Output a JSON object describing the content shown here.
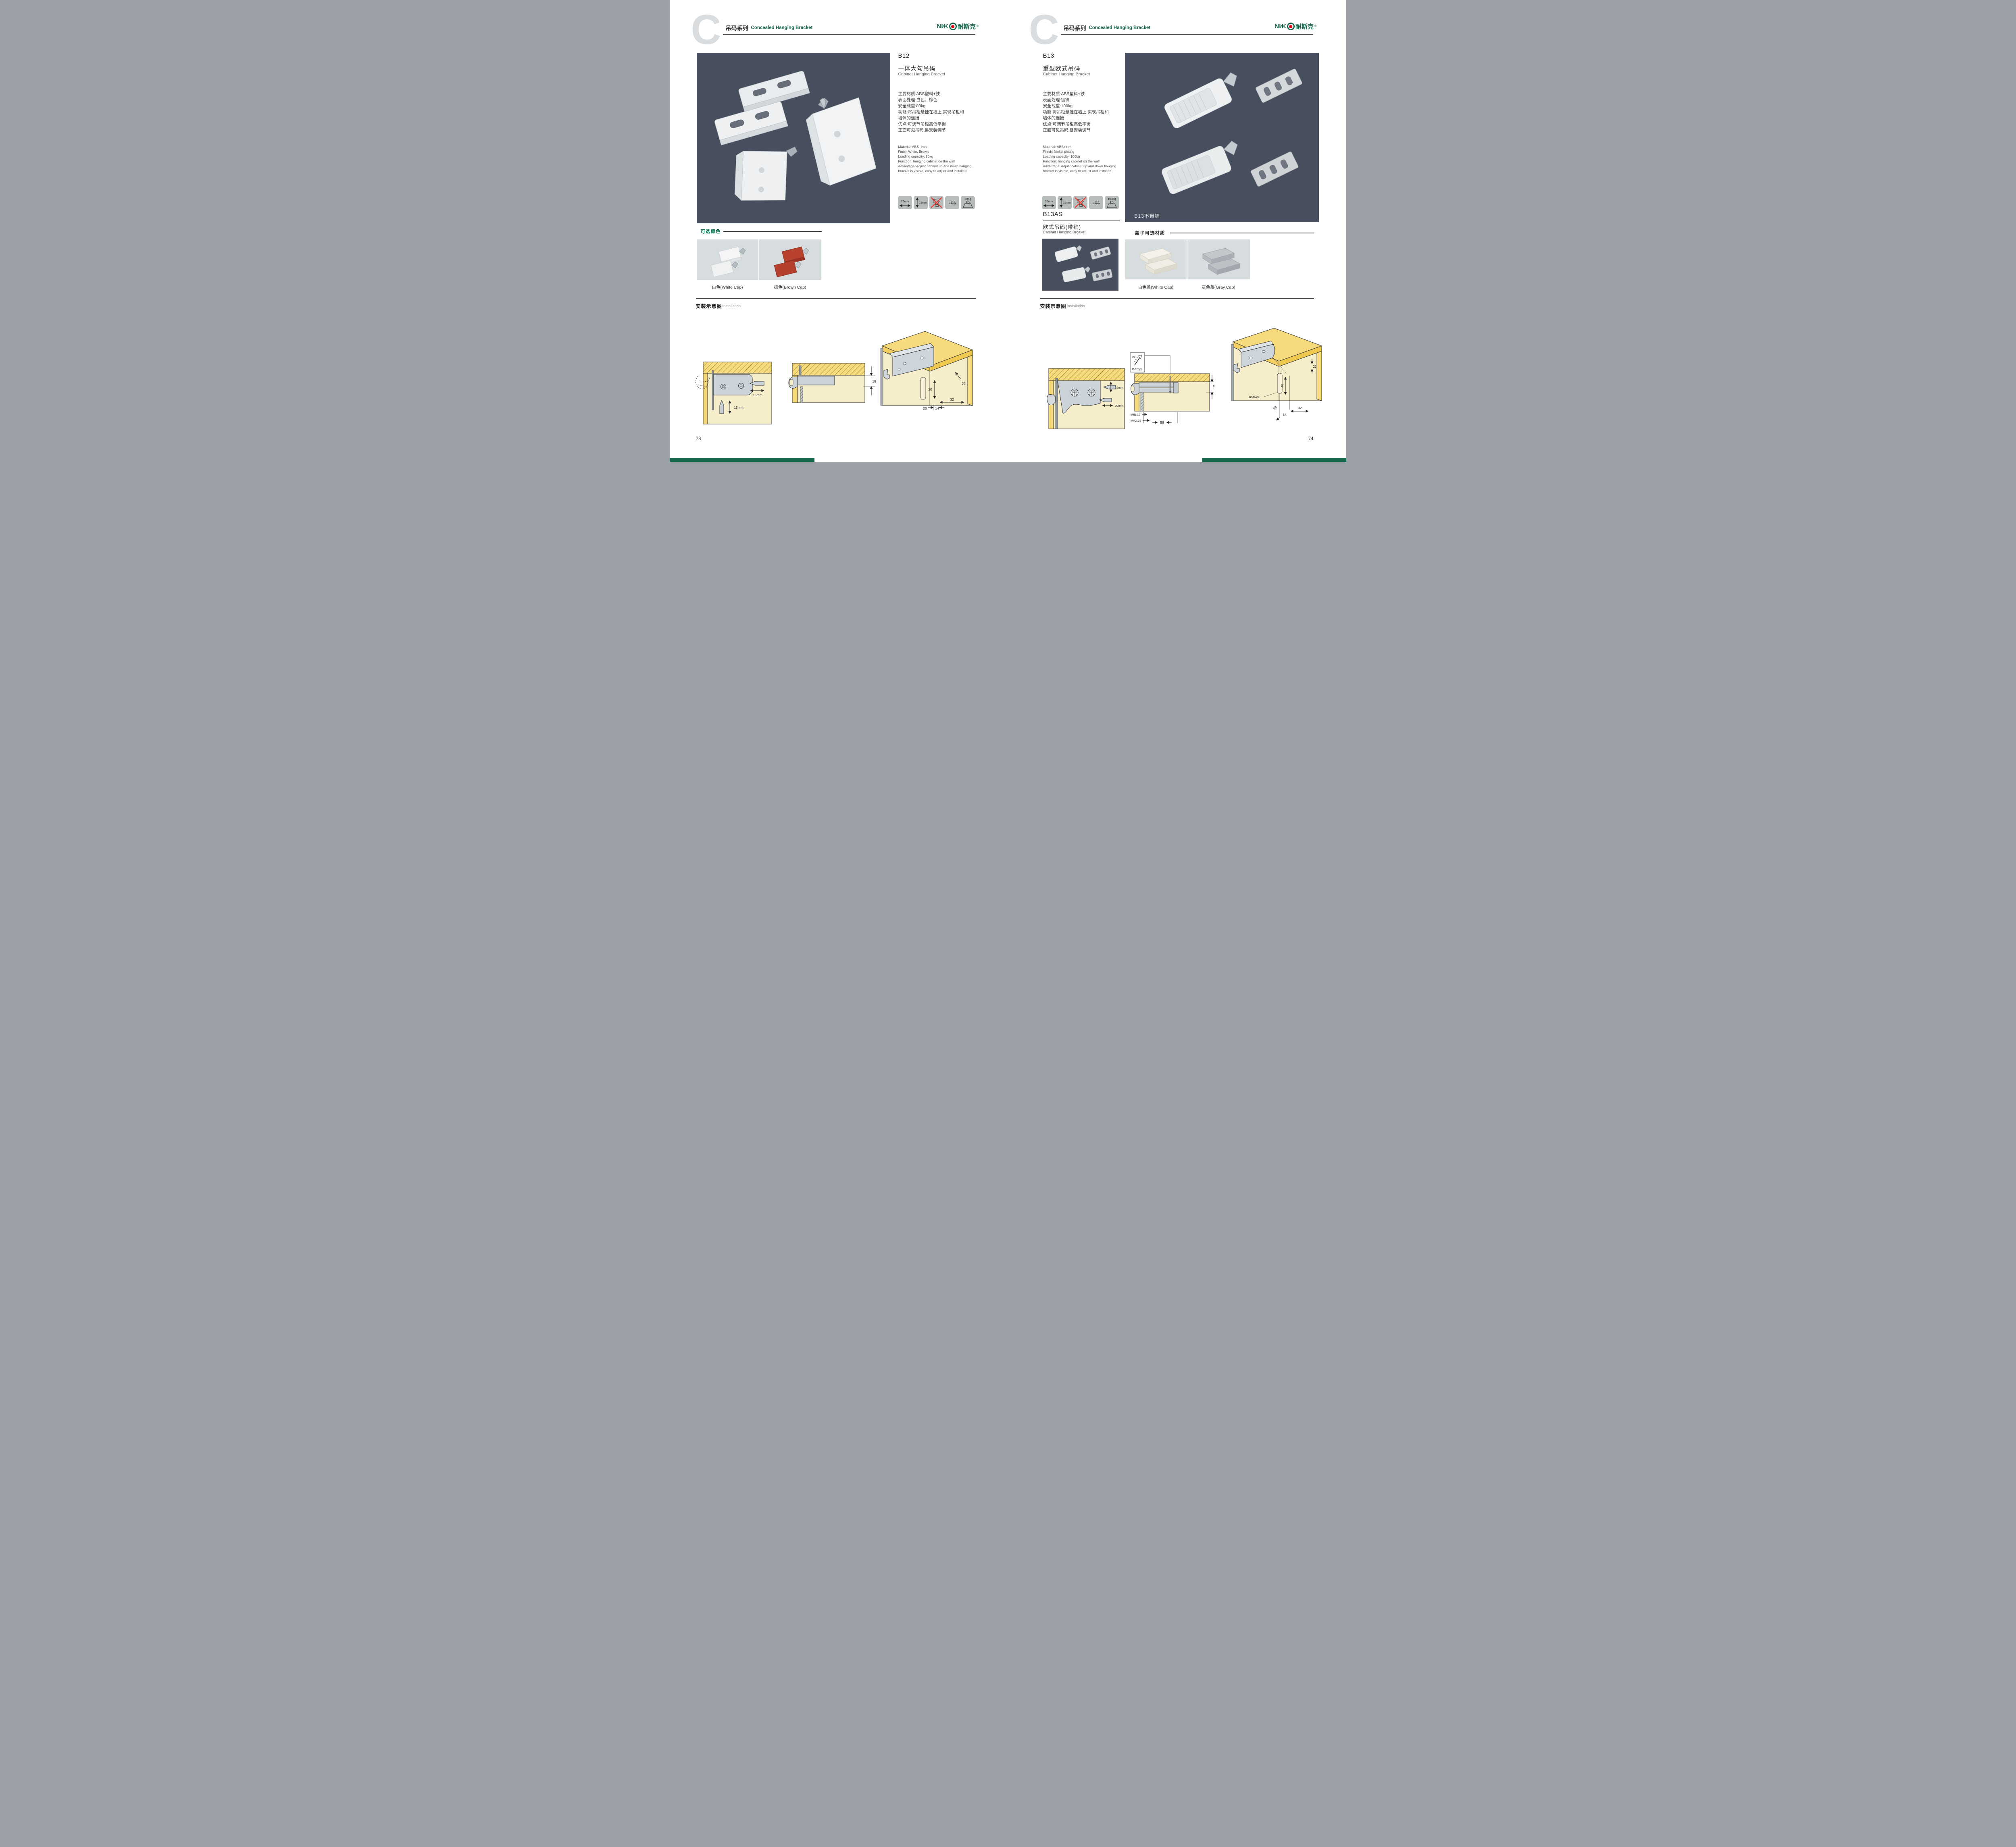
{
  "colors": {
    "brand_green": "#17684a",
    "accent_red": "#e60013",
    "photo_bg": "#474e5d",
    "swatch_bg": "#d7dcdf",
    "icon_bg": "#b7bdbc",
    "wood_yellow": "#f7da7b",
    "panel_beige": "#f6eecb",
    "bottom_bar_green": "#15684b"
  },
  "header": {
    "series_cn": "吊码系列",
    "series_en": "Concealed Hanging Bracket",
    "brand_p1": "NI∕K",
    "brand_cn": "耐斯克",
    "reg": "®"
  },
  "page_left": {
    "product": {
      "code": "B12",
      "name_cn": "一体大勾吊码",
      "name_en": "Cabinet Hanging Bracket",
      "specs_cn": [
        "主要材质:ABS塑料+铁",
        "表面处理:白色、棕色",
        "安全载重:80kg",
        "功能:将吊柜悬挂在墙上,实现吊柜和",
        "墙体的连接",
        "优点:可调节吊柜高低平衡",
        "正面可见吊码,易安装调节"
      ],
      "specs_en": [
        "Material: ABS+iron",
        "Finish:White, Brown",
        "Loading capacity: 80kg",
        "Function: hanging cabinet on the wall",
        "Advantage: Adjust cabinet up and down hanging",
        "bracket is visible, easy to adjust and installed"
      ],
      "icon_width": "16mm",
      "icon_height": "15mm",
      "icon_lga": "LGA",
      "icon_weight": "80Kg"
    },
    "colors_section": {
      "title": "可选颜色",
      "caption_white": "白色(White Cap)",
      "caption_brown": "棕色(Brown Cap)"
    },
    "install": {
      "title_cn": "安装示意图",
      "title_en": "Installation"
    },
    "d1": {
      "w": "16mm",
      "h": "15mm"
    },
    "d2": {
      "gap": "18"
    },
    "d3": {
      "n33": "33",
      "n30": "30",
      "n32": "32",
      "n20": "20",
      "n14": "14"
    },
    "page_no": "73"
  },
  "page_right": {
    "product": {
      "code": "B13",
      "name_cn": "重型欧式吊码",
      "name_en": "Cabinet Hanging Bracket",
      "specs_cn": [
        "主要材质:ABS塑料+铁",
        "表面处理:镀镍",
        "安全载重:100kg",
        "功能:将吊柜悬挂在墙上,实现吊柜和",
        "墙体的连接",
        "优点:可调节吊柜高低平衡",
        "正面可见吊码,易安装调节"
      ],
      "specs_en": [
        "Material: ABS+iron",
        "Finish: Nickel plating",
        "Loading capacity: 100kg",
        "Function: hanging cabinet on the wall",
        "Advantage: Adjust cabinet up and down hanging",
        "bracket is visible, easy to adjust and installed"
      ],
      "icon_width": "20mm",
      "icon_height": "15mm",
      "icon_lga": "LGA",
      "icon_weight": "100Kg"
    },
    "product2": {
      "code": "B13AS",
      "name_cn": "欧式吊码(带销)",
      "name_en": "Cabinet Hanging Brcaket"
    },
    "photo_label": "B13不带销",
    "caps_section": {
      "title": "盖子可选材质",
      "caption_white": "白色盖(White Cap)",
      "caption_gray": "灰色盖(Gray Cap)"
    },
    "install": {
      "title_cn": "安装示意图",
      "title_en": "Installation"
    },
    "d1": {
      "h": "15mm",
      "w": "20mm"
    },
    "badge": {
      "count": "2x",
      "dia": "Φ4mm"
    },
    "d2": {
      "gap": "18",
      "min": "MIN.15",
      "max": "MAX.35",
      "w": "58"
    },
    "d3": {
      "n16": "16",
      "n40": "40",
      "r": "RMAX4",
      "n19": "19",
      "n18": "18",
      "n32": "32"
    },
    "page_no": "74"
  }
}
